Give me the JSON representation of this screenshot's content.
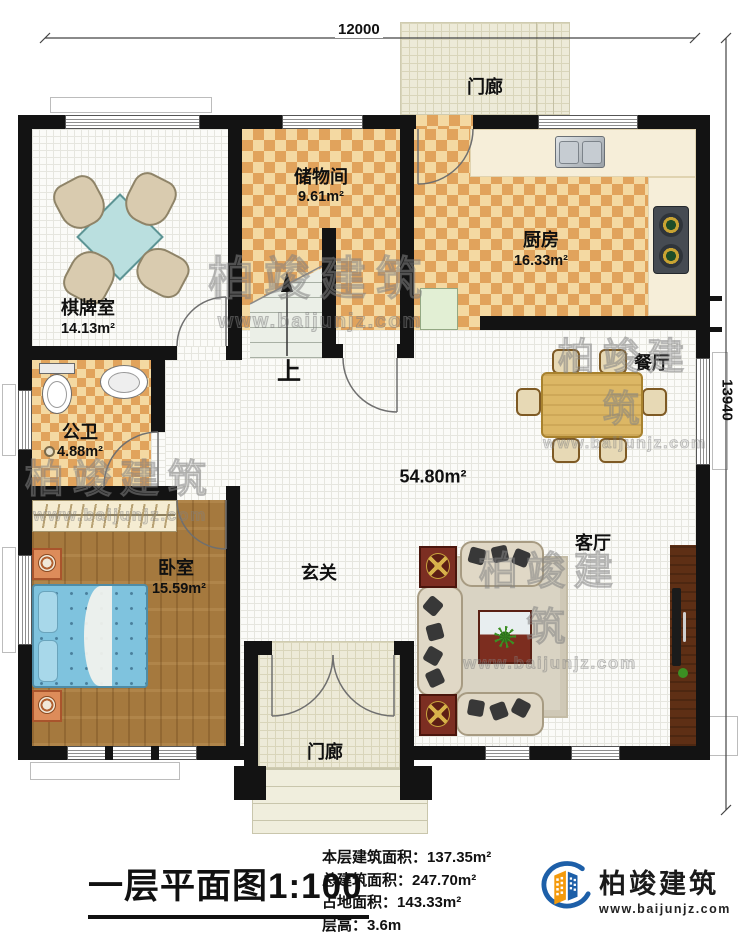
{
  "dimensions": {
    "width_label": "12000",
    "height_label": "13940"
  },
  "rooms": {
    "porch_top": {
      "name": "门廊"
    },
    "storage": {
      "name": "储物间",
      "area": "9.61m²"
    },
    "kitchen": {
      "name": "厨房",
      "area": "16.33m²"
    },
    "game_room": {
      "name": "棋牌室",
      "area": "14.13m²"
    },
    "dining": {
      "name": "餐厅"
    },
    "bathroom": {
      "name": "公卫",
      "area": "4.88m²"
    },
    "hall": {
      "area": "54.80m²"
    },
    "bedroom": {
      "name": "卧室",
      "area": "15.59m²"
    },
    "foyer": {
      "name": "玄关"
    },
    "living": {
      "name": "客厅"
    },
    "porch_bottom": {
      "name": "门廊"
    }
  },
  "stairs": {
    "up_label": "上"
  },
  "footer": {
    "title": "一层平面图",
    "scale": "1:100",
    "stats": [
      {
        "label": "本层建筑面积：",
        "value": "137.35m²"
      },
      {
        "label": "总建筑面积：",
        "value": "247.70m²"
      },
      {
        "label": "占地面积：",
        "value": "143.33m²"
      },
      {
        "label": "层高：",
        "value": "3.6m"
      }
    ]
  },
  "brand": {
    "name": "柏竣建筑",
    "url": "www.baijunjz.com"
  },
  "watermark": {
    "name": "柏竣建筑",
    "url": "www.baijunjz.com"
  },
  "colors": {
    "wall": "#131313",
    "checker_dark": "#e1a35c",
    "checker_light": "#f4d9a2",
    "wood_floor": "#a5793e",
    "brand_blue": "#1d5fa8",
    "brand_orange": "#f49a0c"
  }
}
